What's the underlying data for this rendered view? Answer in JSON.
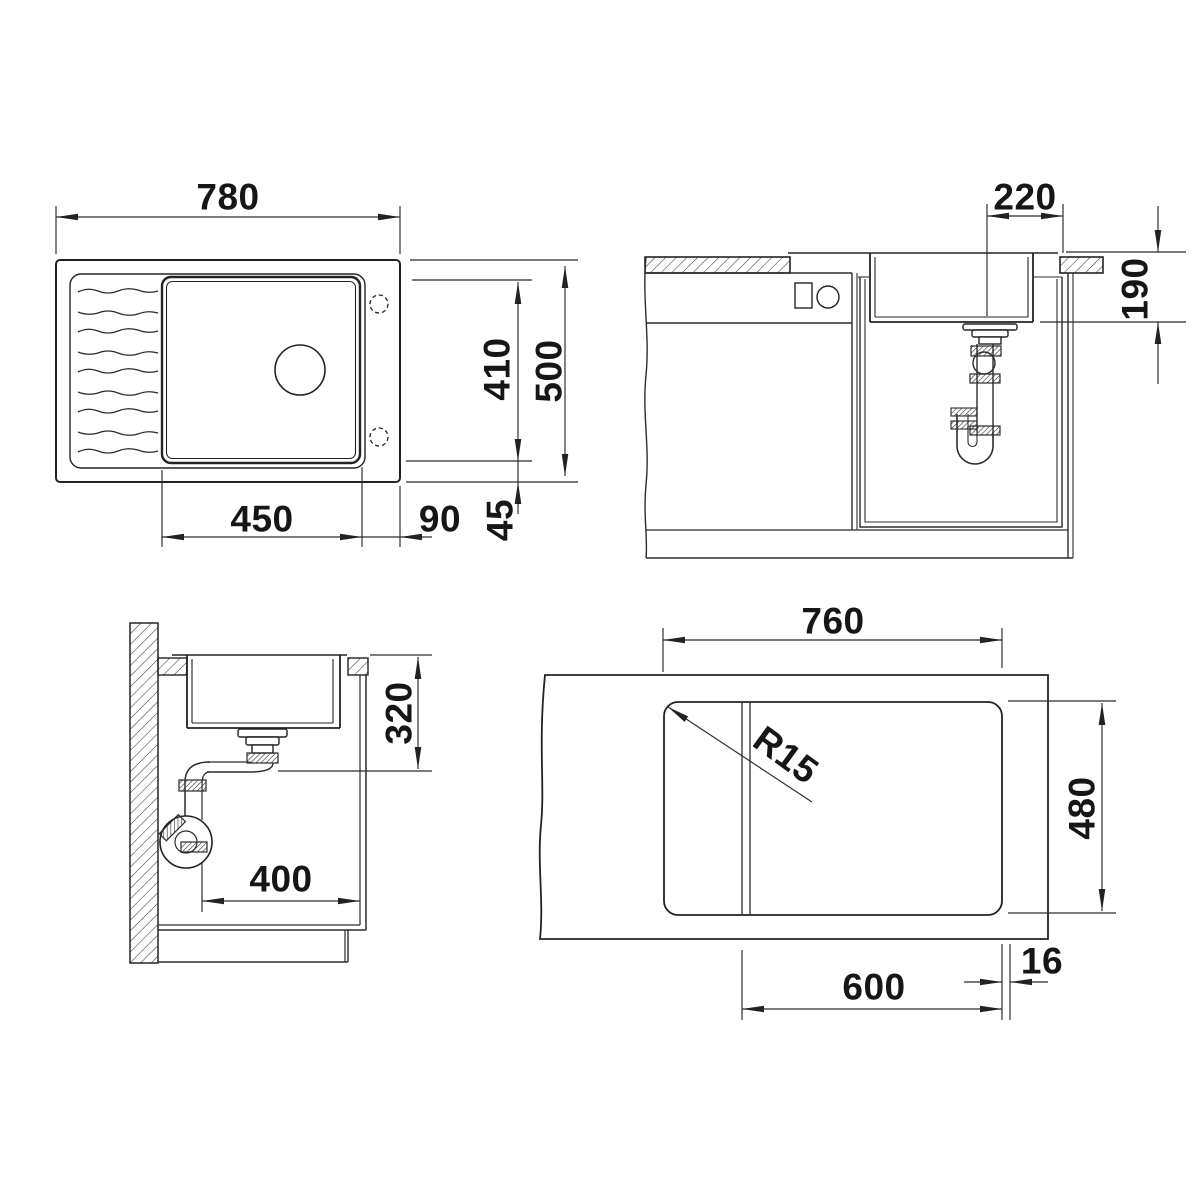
{
  "drawing_title": "sink-installation-technical-drawing",
  "accent_color": "#232323",
  "dims": {
    "plan_overall_length": "780",
    "plan_overall_width": "500",
    "plan_bowl_width": "410",
    "plan_bowl_length": "450",
    "plan_bowl_offset_side": "90",
    "plan_bowl_offset_front": "45",
    "front_drain_offset": "220",
    "front_bowl_depth": "190",
    "side_clearance_depth": "320",
    "side_pipe_clearance": "400",
    "cutout_length": "760",
    "cutout_width": "480",
    "cabinet_width": "600",
    "panel_thickness": "16",
    "corner_radius": "R15"
  }
}
